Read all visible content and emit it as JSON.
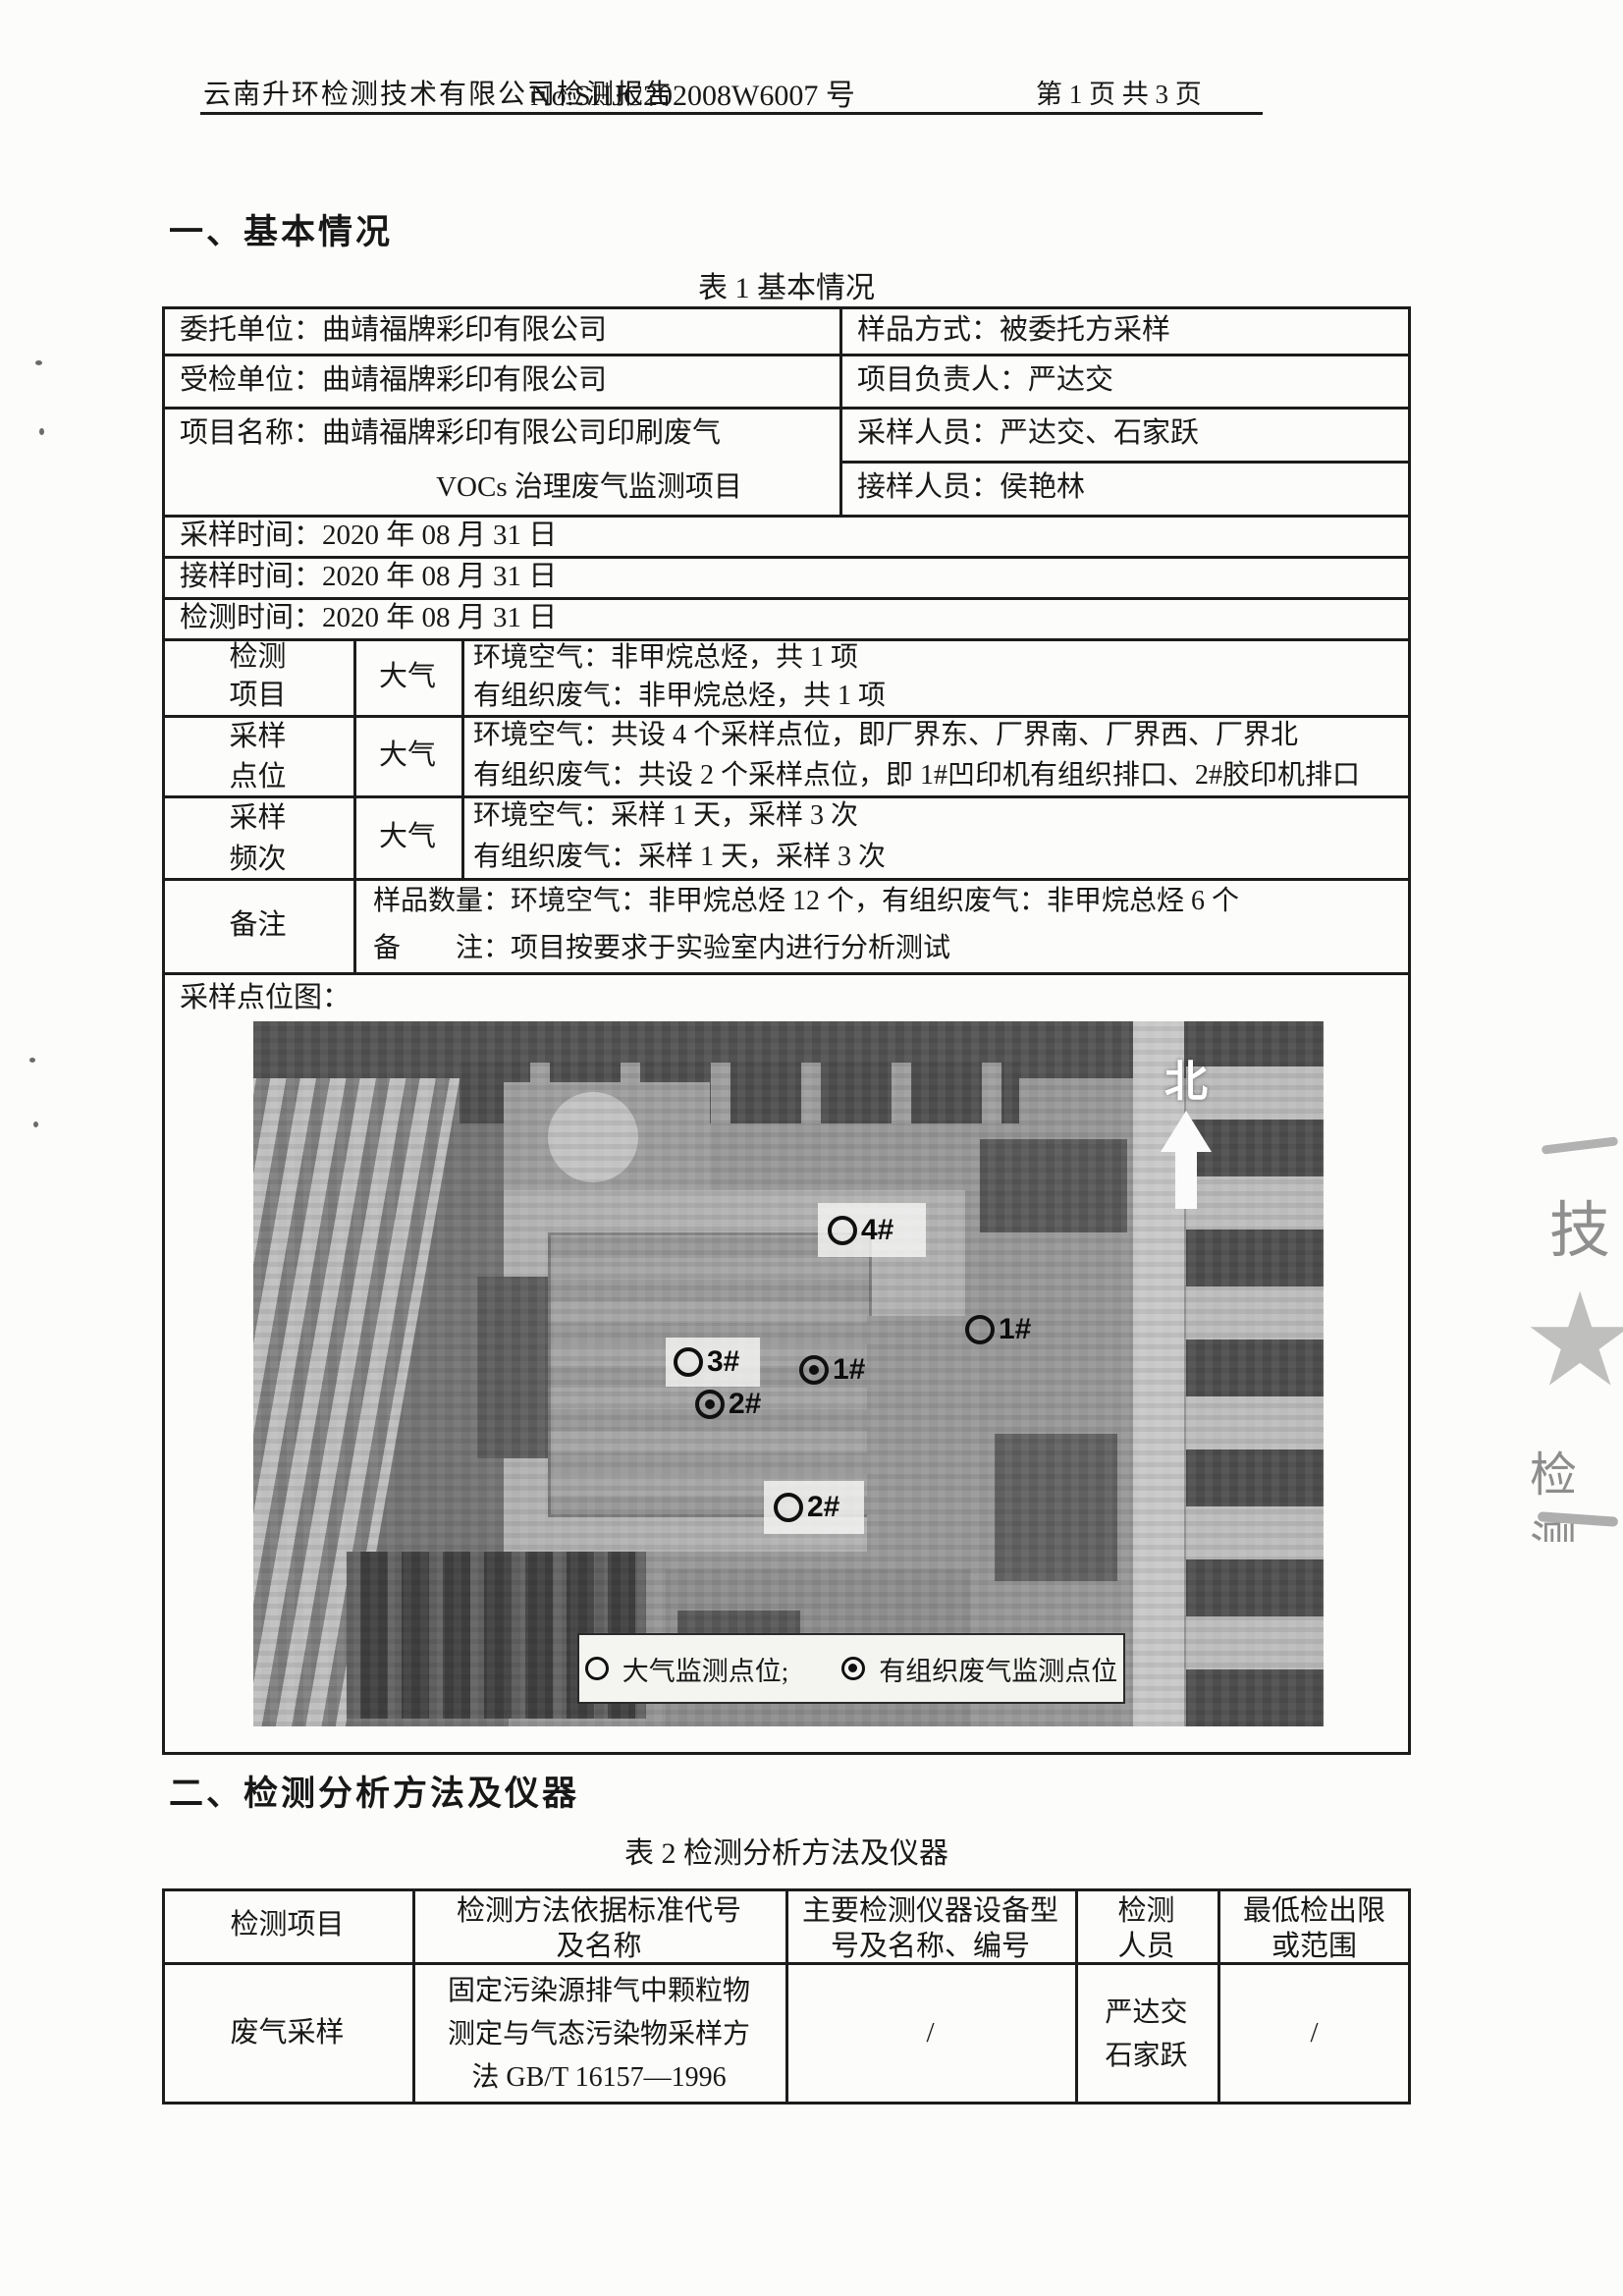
{
  "header": {
    "title": "云南升环检测技术有限公司检测报告",
    "report_no": "No:SHJC202008W6007 号",
    "page_info": "第 1 页 共 3 页"
  },
  "section1": {
    "title": "一、基本情况",
    "table_caption": "表 1 基本情况"
  },
  "table1": {
    "entrust_unit": "委托单位：曲靖福牌彩印有限公司",
    "sample_method": "样品方式：被委托方采样",
    "inspected_unit": "受检单位：曲靖福牌彩印有限公司",
    "project_leader": "项目负责人：严达交",
    "project_name_line1": "项目名称：曲靖福牌彩印有限公司印刷废气",
    "project_name_line2": "VOCs 治理废气监测项目",
    "samplers": "采样人员：严达交、石家跃",
    "sample_receiver": "接样人员：侯艳林",
    "sampling_time": "采样时间：2020 年 08 月 31 日",
    "receiving_time": "接样时间：2020 年 08 月 31 日",
    "testing_time": "检测时间：2020 年 08 月 31 日",
    "test_items": {
      "label": "检测\n项目",
      "category": "大气",
      "line1": "环境空气：非甲烷总烃，共 1 项",
      "line2": "有组织废气：非甲烷总烃，共 1 项"
    },
    "sampling_points": {
      "label": "采样\n点位",
      "category": "大气",
      "line1": "环境空气：共设 4 个采样点位，即厂界东、厂界南、厂界西、厂界北",
      "line2": "有组织废气：共设 2 个采样点位，即 1#凹印机有组织排口、2#胶印机排口"
    },
    "sampling_frequency": {
      "label": "采样\n频次",
      "category": "大气",
      "line1": "环境空气：采样 1 天，采样 3 次",
      "line2": "有组织废气：采样 1 天，采样 3 次"
    },
    "remark": {
      "label": "备注",
      "line1": "样品数量：环境空气：非甲烷总烃 12 个，有组织废气：非甲烷总烃 6 个",
      "line2": "备　　注：项目按要求于实验室内进行分析测试"
    },
    "map_label": "采样点位图："
  },
  "map": {
    "north_label": "北",
    "markers": [
      {
        "label": "4#",
        "type": "air"
      },
      {
        "label": "1#",
        "type": "air"
      },
      {
        "label": "3#",
        "type": "air"
      },
      {
        "label": "1#",
        "type": "organized"
      },
      {
        "label": "2#",
        "type": "organized"
      },
      {
        "label": "2#",
        "type": "air"
      }
    ],
    "legend": {
      "air_label": "大气监测点位;",
      "organized_label": "有组织废气监测点位"
    }
  },
  "section2": {
    "title": "二、检测分析方法及仪器",
    "table_caption": "表 2 检测分析方法及仪器"
  },
  "table2": {
    "headers": [
      "检测项目",
      "检测方法依据标准代号\n及名称",
      "主要检测仪器设备型\n号及名称、编号",
      "检测\n人员",
      "最低检出限\n或范围"
    ],
    "row": {
      "item": "废气采样",
      "method": "固定污染源排气中颗粒物\n测定与气态污染物采样方\n法  GB/T 16157—1996",
      "instrument": "/",
      "personnel": "严达交\n石家跃",
      "detection_limit": "/"
    }
  },
  "stamp": {
    "top_char": "技",
    "bottom_text": "检测"
  }
}
